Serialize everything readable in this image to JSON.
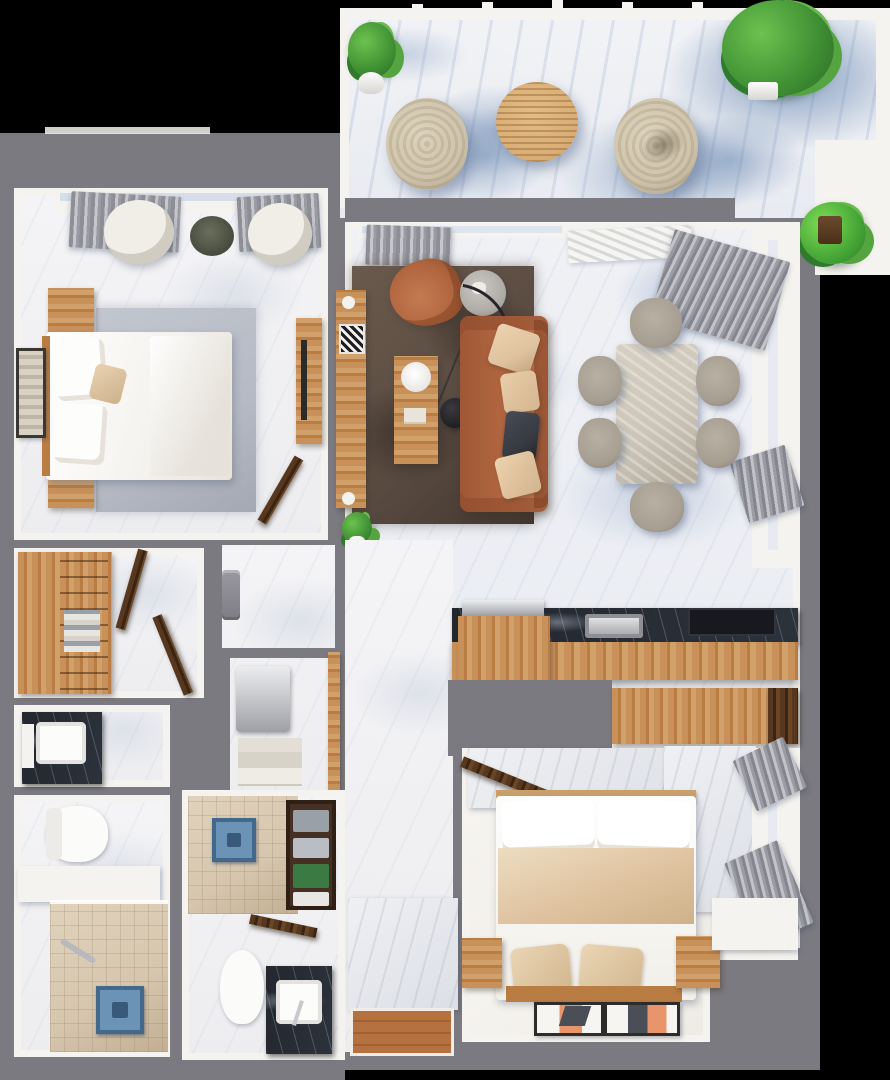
{
  "meta": {
    "description": "3D top-down rendered floor plan of a two-bedroom apartment with balcony terrace, living-dining room, kitchen, walk-in closet, two bathrooms and entry hall"
  },
  "palette": {
    "background": "#000000",
    "wall": "#7b7a80",
    "wall_face": "#f5f3ef",
    "marble_base": "#f0f1f5",
    "marble_blue": "#a9bdd8",
    "marble_deep": "#7f9cc2",
    "wood": "#c9915a",
    "wood_mid": "#b97c42",
    "wood_dark": "#57371e",
    "leather": "#b0653f",
    "pillow_beige": "#dfc3a0",
    "pillow_dark": "#383b42",
    "rug_living": "#5a4b41",
    "rug_master": "#b6bac4",
    "chair_white": "#f1eee8",
    "dining_chair": "#a79e92",
    "dining_table": "#ccc5b8",
    "pouf": "#cfc3ab",
    "plant": "#3f8f33",
    "plant_bright": "#6cc24f",
    "black_marble": "#23272e",
    "tile": "#d6c6ae",
    "fixture_blue": "#6b93b5",
    "curtain": "#9b9ca3",
    "entry_wood": "#b5713f"
  },
  "floorplan": {
    "rooms": [
      {
        "name": "balcony-terrace",
        "floor": "blue-veined marble",
        "furniture": [
          "potted-plant",
          "woven-pouf",
          "round-slat-coffee-table",
          "woven-pouf",
          "large-potted-plant",
          "small-potted-plant"
        ]
      },
      {
        "name": "master-bedroom",
        "floor": "white marble",
        "furniture": [
          "window-curtains",
          "lounge-chair",
          "lounge-chair",
          "small-round-rug",
          "gray-area-rug",
          "double-bed",
          "nightstand",
          "nightstand",
          "leaning-framed-art",
          "wood-dresser",
          "open-door"
        ]
      },
      {
        "name": "living-room",
        "floor": "white-blue marble",
        "furniture": [
          "window-curtains",
          "tv-console",
          "leather-armchair",
          "round-side-table",
          "arc-floor-lamp",
          "leather-sofa",
          "wood-coffee-table",
          "dark-brown-rug",
          "potted-plant"
        ]
      },
      {
        "name": "dining-room",
        "floor": "white-blue marble",
        "furniture": [
          "stone-dining-table",
          "dining-chair",
          "dining-chair",
          "dining-chair",
          "dining-chair",
          "dining-chair",
          "dining-chair",
          "window-curtains",
          "wall-vent"
        ]
      },
      {
        "name": "kitchen",
        "furniture": [
          "black-marble-counter",
          "sink",
          "cooktop",
          "wood-cabinet",
          "silver-appliance",
          "wood-island",
          "dark-wood-cabinet"
        ]
      },
      {
        "name": "bedroom-2",
        "floor": "warm white",
        "furniture": [
          "marble-accent-wall",
          "open-door",
          "double-bed",
          "headboard",
          "nightstand",
          "nightstand",
          "framed-art",
          "framed-art",
          "window-curtains",
          "window-curtains"
        ]
      },
      {
        "name": "walk-in-closet",
        "furniture": [
          "wardrobe-shelving",
          "open-door",
          "open-door"
        ]
      },
      {
        "name": "bathroom-1",
        "furniture": [
          "dark-marble-vanity",
          "white-basin",
          "toilet",
          "bench-counter",
          "tiled-shower",
          "blue-shower-fixture"
        ]
      },
      {
        "name": "bathroom-2",
        "furniture": [
          "tiled-shower",
          "blue-shower-fixture",
          "towel-niche",
          "open-door",
          "toilet",
          "dark-marble-vanity",
          "white-basin"
        ]
      },
      {
        "name": "utility-closet",
        "furniture": [
          "water-heater",
          "drawer-unit",
          "door-frame"
        ]
      },
      {
        "name": "entry-hall",
        "floor": "marble + wood entry mat",
        "furniture": [
          "wall-intercom",
          "entry-wall-block",
          "wood-entry-floor"
        ]
      }
    ]
  }
}
